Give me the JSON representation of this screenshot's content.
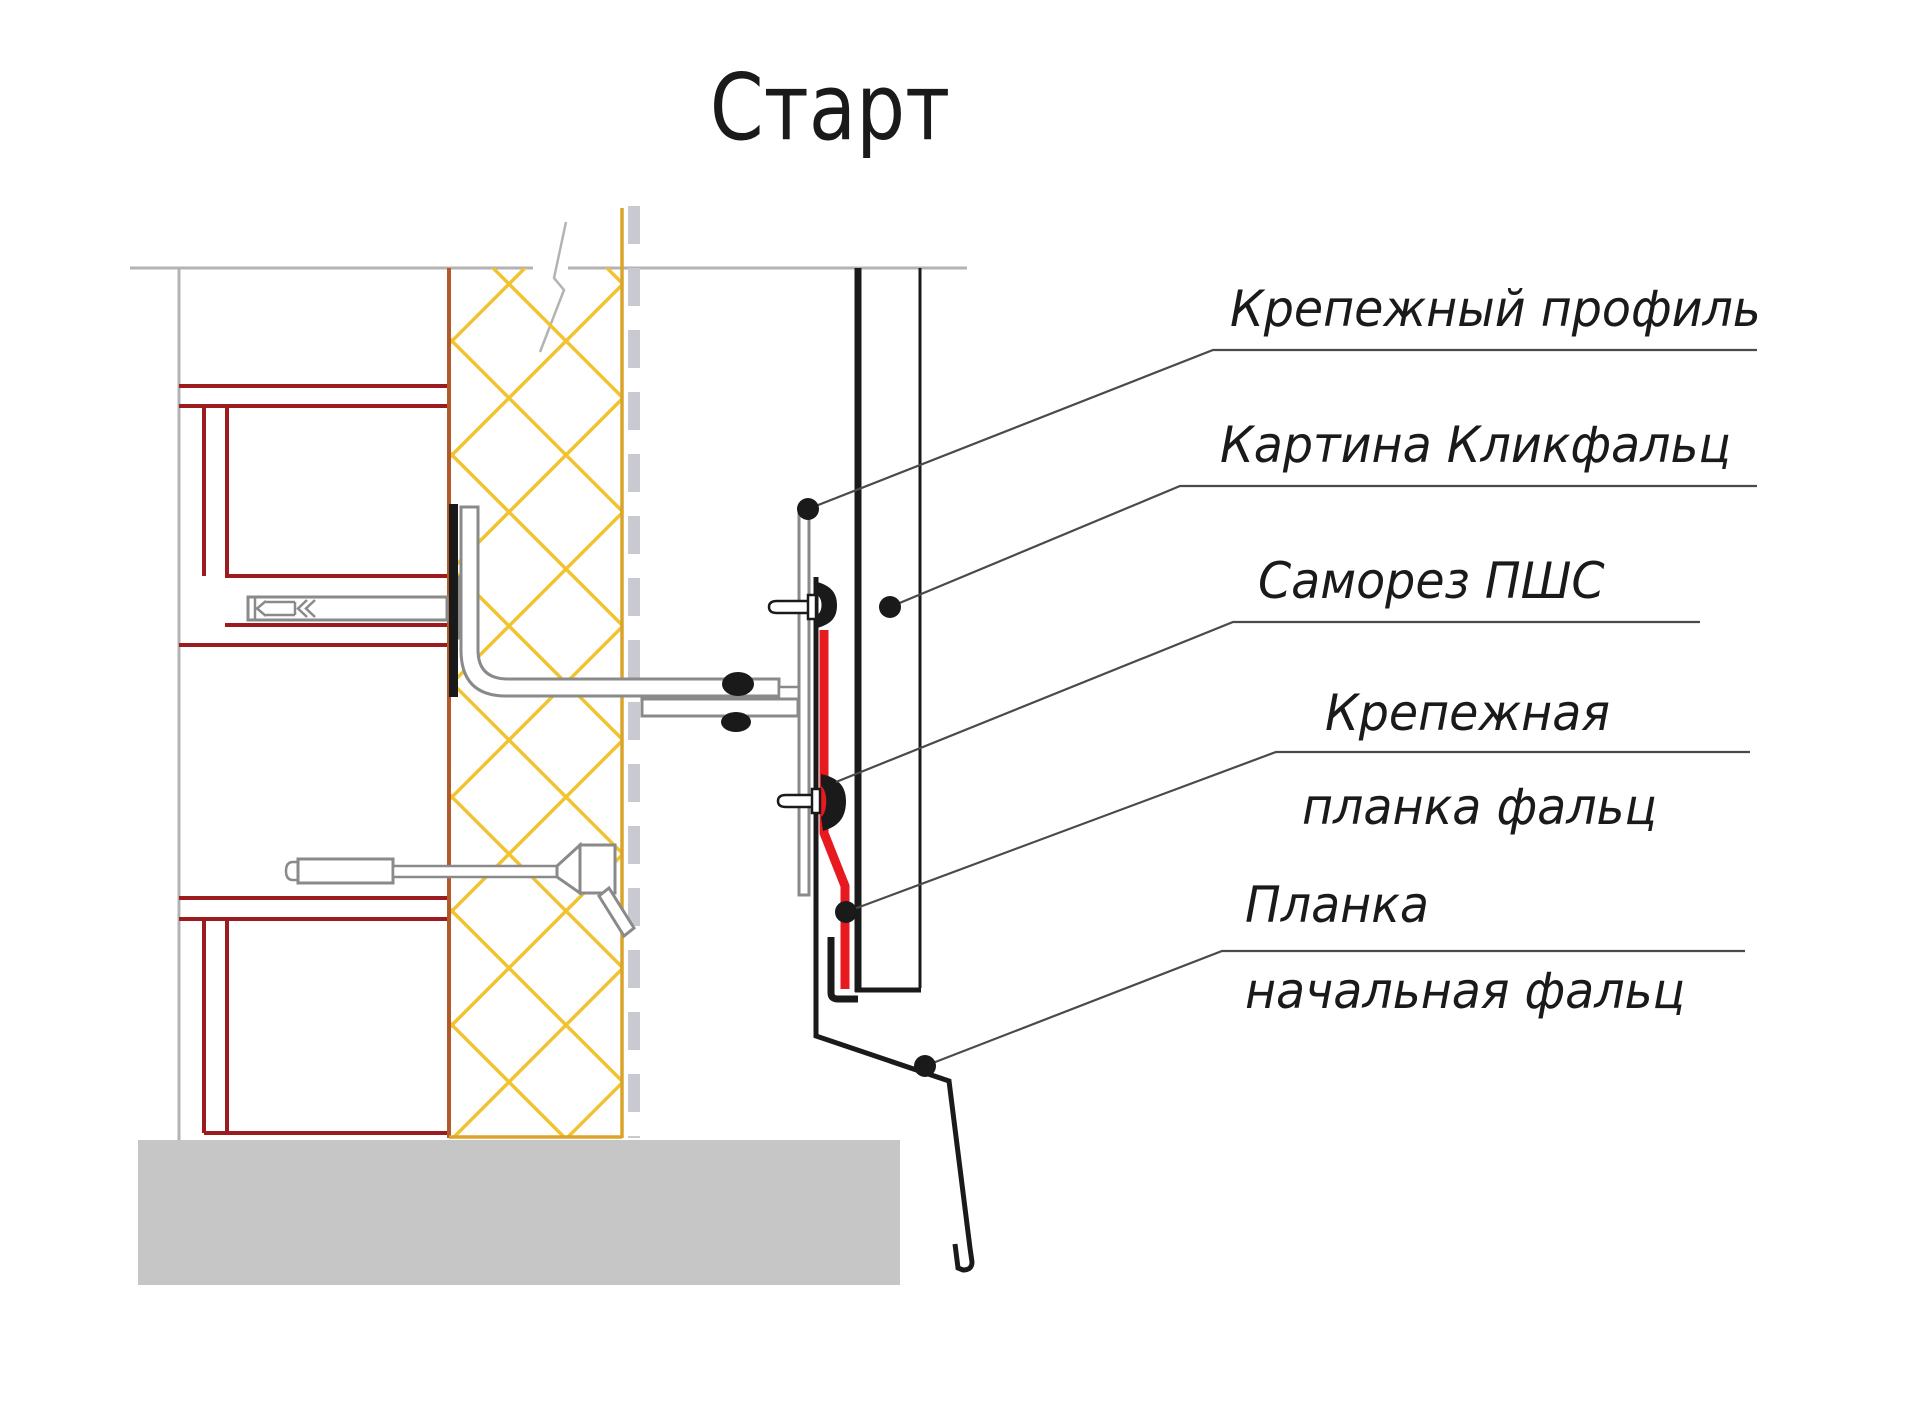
{
  "title": "Старт",
  "callouts": [
    {
      "id": "fastening-profile",
      "text": "Крепежный профиль"
    },
    {
      "id": "click-seam-panel",
      "text": "Картина Кликфальц"
    },
    {
      "id": "self-tapping-screw",
      "text": "Саморез ПШС"
    },
    {
      "id": "fastening-strip",
      "line1": "Крепежная",
      "line2": "планка фальц"
    },
    {
      "id": "starting-strip",
      "line1": "Планка",
      "line2": "начальная фальц"
    }
  ],
  "colors": {
    "ink": "#1a1a1a",
    "red": "#e8191f",
    "maroon": "#9c1b1f",
    "yellow": "#f2c331",
    "ocher": "#b2592a",
    "dark-yellow": "#dba32a",
    "gray-line": "#b3b3b3",
    "steel": "#8a8a8a",
    "membrane": "#c9c9d2",
    "base-gray": "#c6c6c6",
    "leader": "#4a4a4a"
  }
}
